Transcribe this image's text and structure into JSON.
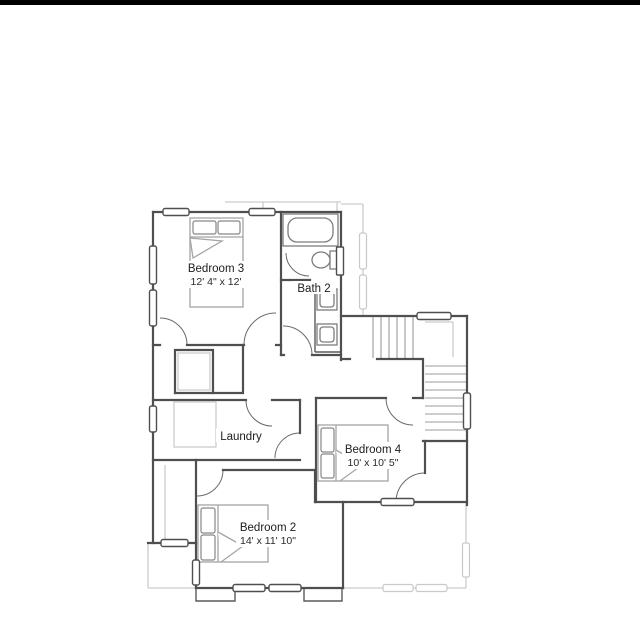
{
  "meta": {
    "background_color": "#ffffff",
    "top_bar_color": "#000000",
    "wall_color": "#4f4f4f",
    "light_outline_color": "#cccccc",
    "stair_tread_color": "#9b9b9b",
    "text_color": "#1c1c1c"
  },
  "rooms": [
    {
      "id": "bedroom3",
      "name": "Bedroom 3",
      "dims": "12' 4\" x 12'"
    },
    {
      "id": "bath2",
      "name": "Bath 2",
      "dims": ""
    },
    {
      "id": "laundry",
      "name": "Laundry",
      "dims": ""
    },
    {
      "id": "bedroom4",
      "name": "Bedroom 4",
      "dims": "10' x 10' 5\""
    },
    {
      "id": "bedroom2",
      "name": "Bedroom 2",
      "dims": "14' x 11' 10\""
    }
  ],
  "fixtures": [
    "bathtub",
    "toilet",
    "double-vanity-sinks",
    "bed",
    "bed",
    "bed",
    "staircase",
    "washer-dryer-counter",
    "closet-shelf"
  ]
}
